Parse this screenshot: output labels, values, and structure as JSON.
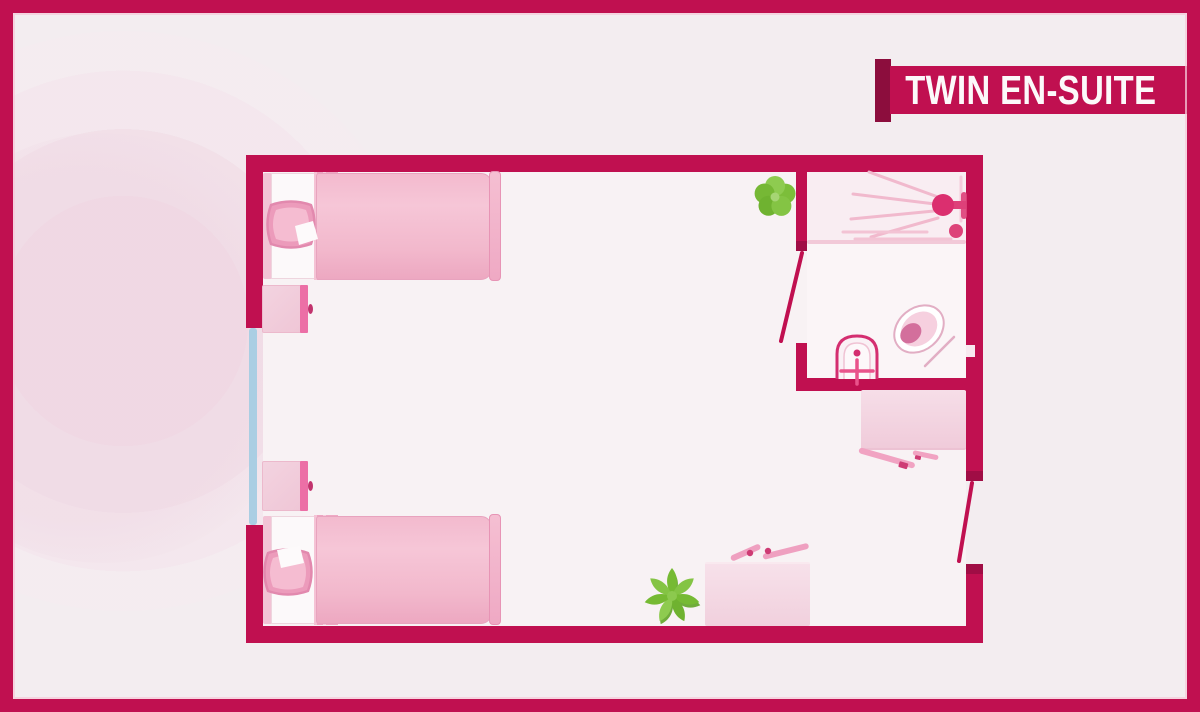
{
  "banner": {
    "label": "TWIN EN-SUITE"
  },
  "colors": {
    "accent_crimson": "#c01050",
    "accent_dark": "#8c0d3d",
    "background": "#f3edf0",
    "floor": "#f8f2f4",
    "furniture_pink": "#f2bcce",
    "duvet_pink": "#f3bace",
    "window_blue": "#aacee3",
    "plant_green": "#76ba33",
    "banner_text": "#fcf9fa"
  },
  "floorplan": {
    "room_type": "twin bedroom with en-suite bathroom",
    "items": [
      {
        "name": "bed-top",
        "type": "single bed with pillow and duvet"
      },
      {
        "name": "bed-bottom",
        "type": "single bed with pillow and duvet"
      },
      {
        "name": "nightstand-top",
        "type": "bedside table"
      },
      {
        "name": "nightstand-bottom",
        "type": "bedside table"
      },
      {
        "name": "window-left",
        "type": "window"
      },
      {
        "name": "plant-top",
        "type": "potted plant"
      },
      {
        "name": "plant-bottom",
        "type": "potted plant"
      },
      {
        "name": "desk-right",
        "type": "desk with two chairs"
      },
      {
        "name": "desk-bottom",
        "type": "desk with two chairs"
      },
      {
        "name": "bathroom-door",
        "type": "door swing"
      },
      {
        "name": "entrance-door",
        "type": "door swing"
      },
      {
        "name": "shower",
        "type": "shower head with spray and drain"
      },
      {
        "name": "sink",
        "type": "washbasin with faucet"
      },
      {
        "name": "toilet",
        "type": "toilet"
      }
    ]
  }
}
